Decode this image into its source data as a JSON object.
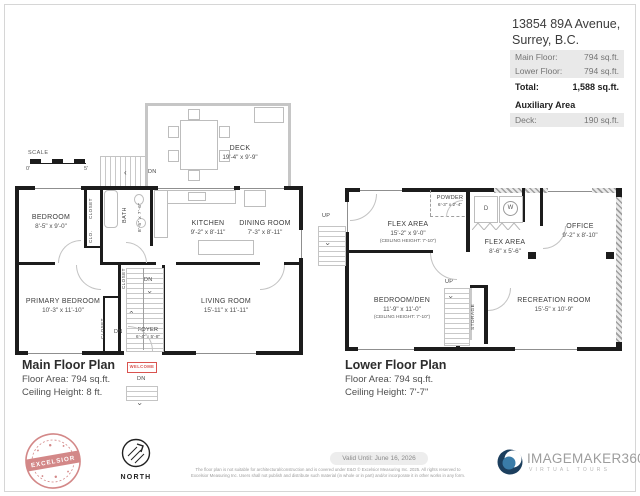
{
  "header": {
    "address1": "13854 89A Avenue,",
    "address2": "Surrey, B.C.",
    "areas": {
      "rows": [
        {
          "label": "Main Floor:",
          "value": "794 sq.ft."
        },
        {
          "label": "Lower Floor:",
          "value": "794 sq.ft."
        },
        {
          "label": "Total:",
          "value": "1,588 sq.ft."
        }
      ],
      "aux_title": "Auxiliary Area",
      "aux": {
        "label": "Deck:",
        "value": "190 sq.ft."
      }
    }
  },
  "scale": {
    "label": "SCALE",
    "min": "0'",
    "max": "5'"
  },
  "mf": {
    "title": "Main Floor Plan",
    "area": "Floor Area: 794 sq.ft.",
    "ceiling": "Ceiling Height: 8 ft.",
    "deck": {
      "name": "DECK",
      "dims": "19'-4\" x 9'-9\""
    },
    "bedroom": {
      "name": "BEDROOM",
      "dims": "8'-5\" x 9'-0\""
    },
    "bath": {
      "name": "BATH",
      "dims": "8'-5\" x 7'-6\""
    },
    "kitchen": {
      "name": "KITCHEN",
      "dims": "9'-2\" x 8'-11\""
    },
    "dining": {
      "name": "DINING ROOM",
      "dims": "7'-3\" x 8'-11\""
    },
    "primary": {
      "name": "PRIMARY BEDROOM",
      "dims": "10'-3\" x 11'-10\""
    },
    "living": {
      "name": "LIVING ROOM",
      "dims": "15'-11\" x 11'-11\""
    },
    "foyer": {
      "name": "FOYER",
      "dims": "6'-4\" x 5'-8\""
    },
    "closet": "CLOSET",
    "clo": "CLO.",
    "dn": "DN",
    "welcome": "WELCOME"
  },
  "lf": {
    "title": "Lower Floor Plan",
    "area": "Floor Area: 794 sq.ft.",
    "ceiling": "Ceiling Height: 7'-7\"",
    "flex1": {
      "name": "FLEX AREA",
      "dims": "15'-2\" x 9'-0\"",
      "note": "(CEILING HEIGHT: 7'-10\")"
    },
    "powder": {
      "name": "POWDER",
      "dims": "6'-3\" x 2'-4\""
    },
    "office": {
      "name": "OFFICE",
      "dims": "9'-2\" x 8'-10\""
    },
    "flex2": {
      "name": "FLEX AREA",
      "dims": "8'-6\" x 5'-6\""
    },
    "bedroom_den": {
      "name": "BEDROOM/DEN",
      "dims": "11'-9\" x 11'-0\"",
      "note": "(CEILING HEIGHT: 7'-10\")"
    },
    "rec": {
      "name": "RECREATION ROOM",
      "dims": "15'-5\" x 10'-9\""
    },
    "storage": "STORAGE",
    "dryer": "D",
    "washer": "W",
    "up": "UP"
  },
  "footer": {
    "valid": "Valid Until: June 16, 2026",
    "disclaimer1": "The floor plan is not suitable for architectural/construction and is covered under E&O © Excelsior Measuring Inc. 2025. All rights reserved to",
    "disclaimer2": "Excelsior Measuring Inc. Users shall not publish and distribute such material (in whole or in part) and/or incorporate it in other works in any form.",
    "north": "NORTH",
    "excelsior": "EXCELSIOR",
    "im_name": "IMAGEMAKER360",
    "im_tag": "VIRTUAL TOURS"
  },
  "colors": {
    "wall_black": "#1c1c1c",
    "deck_gray": "#c6c6c6",
    "shade_gray": "#e9e9e9",
    "welcome_red": "#d9534f",
    "excelsior_red": "#c96b6b",
    "logo_navy": "#1c3f5e",
    "logo_blue": "#3a7ca8"
  }
}
